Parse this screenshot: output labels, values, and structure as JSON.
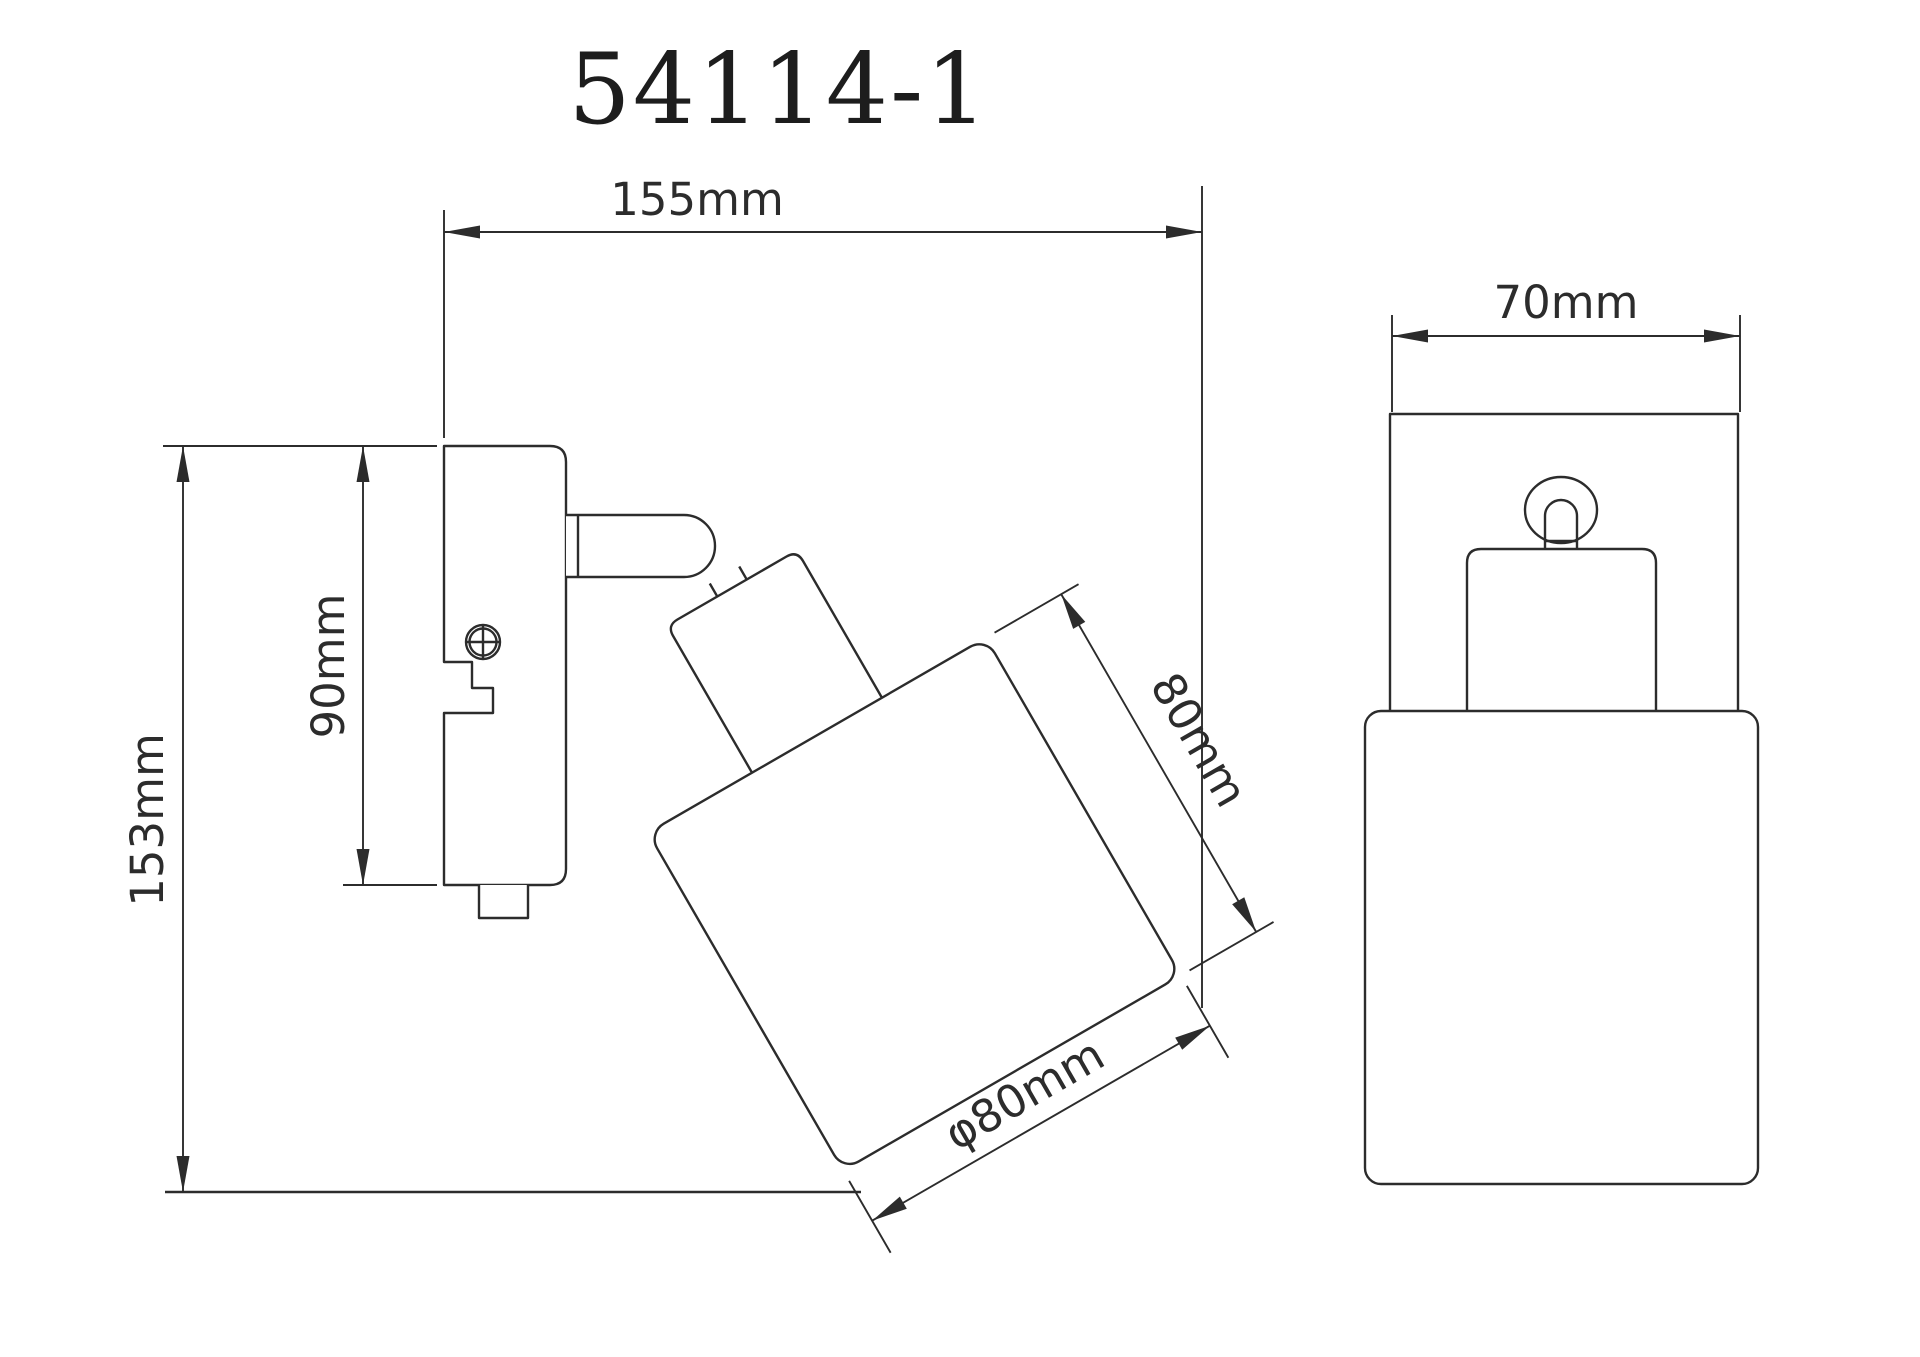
{
  "title": "54114-1",
  "colors": {
    "line": "#2c2c2c",
    "background": "#ffffff"
  },
  "side_view": {
    "dimensions": {
      "total_width": "155mm",
      "total_height": "153mm",
      "backplate_height": "90mm",
      "shade_length": "80mm",
      "shade_diameter": "φ80mm"
    }
  },
  "front_view": {
    "dimensions": {
      "width": "70mm"
    }
  }
}
